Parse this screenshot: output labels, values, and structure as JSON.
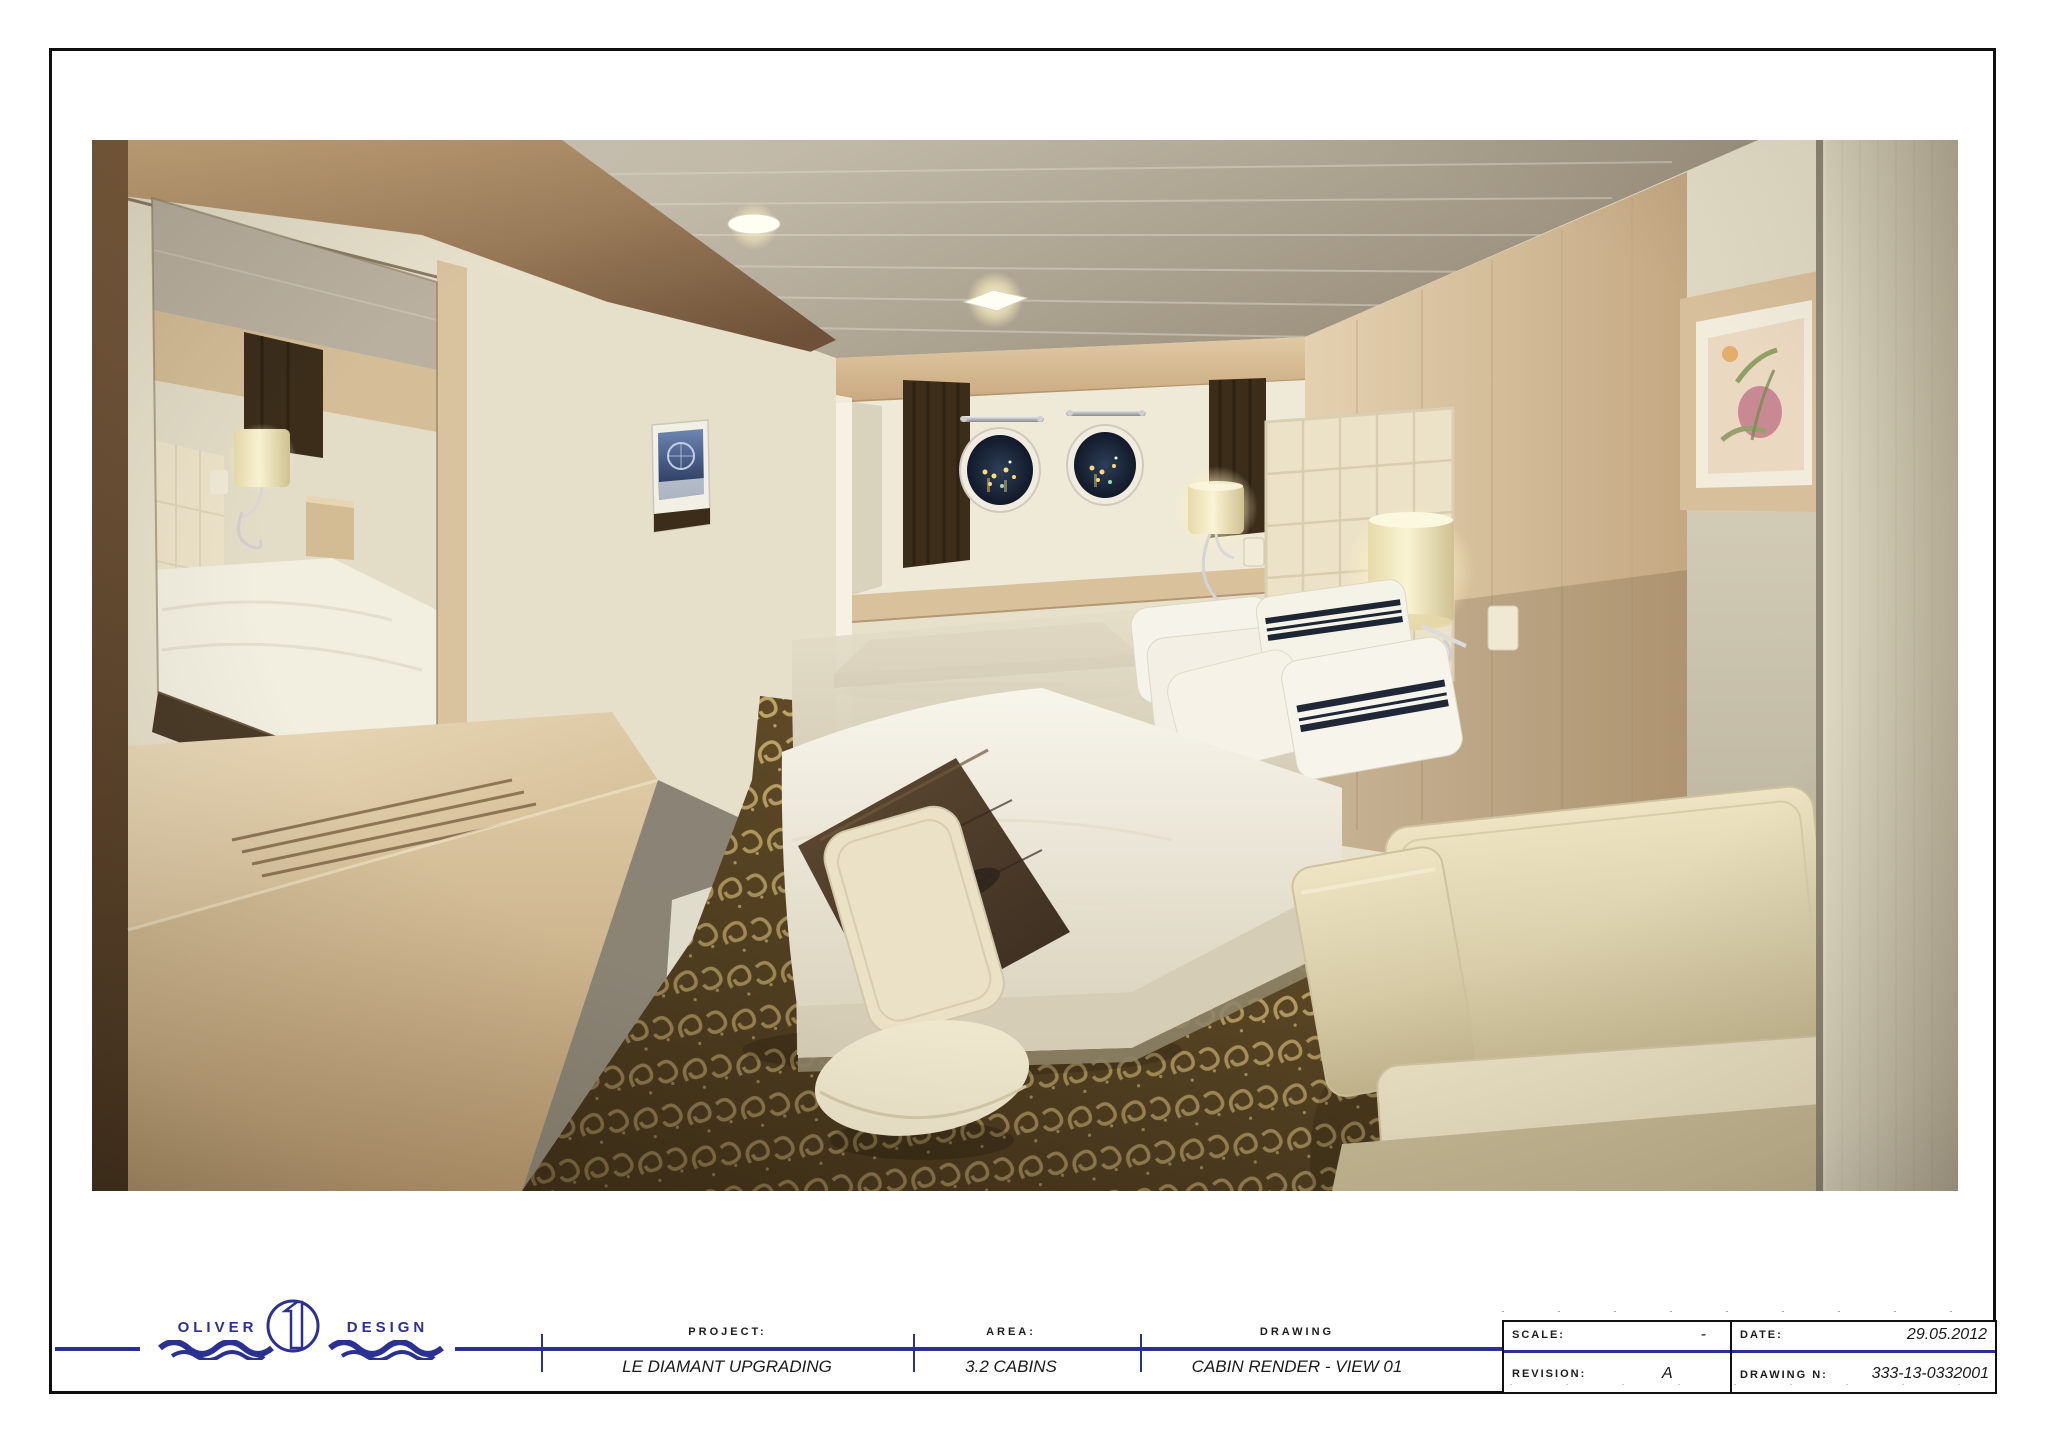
{
  "logo": {
    "word1": "OLIVER",
    "word2": "DESIGN"
  },
  "title_block": {
    "sections": [
      {
        "label": "PROJECT:",
        "value": "LE DIAMANT UPGRADING"
      },
      {
        "label": "AREA:",
        "value": "3.2 CABINS"
      },
      {
        "label": "DRAWING",
        "value": "CABIN RENDER - VIEW 01"
      }
    ],
    "info_box": {
      "scale_label": "SCALE:",
      "scale_value": "-",
      "date_label": "DATE:",
      "date_value": "29.05.2012",
      "revision_label": "REVISION:",
      "revision_value": "A",
      "drawing_number_label": "DRAWING N:",
      "drawing_number_value": "333-13-0332001"
    }
  },
  "render": {
    "subject": "ship-cabin-interior-render",
    "colors": {
      "navy": "#2b3192",
      "ceiling": "#cfc7b7",
      "ceilingDark": "#978d79",
      "woodLight": "#e0cba8",
      "wood": "#cdb189",
      "woodDark": "#6e5138",
      "wallCream": "#e7e0cb",
      "niche": "#efe9d7",
      "curtain": "#3b2d1a",
      "headboard": "#ece2c8",
      "bedWhite": "#f4f1e6",
      "runner": "#55422e",
      "pillowStripe": "#1e2633",
      "sofa": "#e6dbba",
      "carpet": "#5d4926",
      "carpetScroll": "#bfa468",
      "lampGlow": "#fff6d2",
      "night": "#101826"
    }
  }
}
